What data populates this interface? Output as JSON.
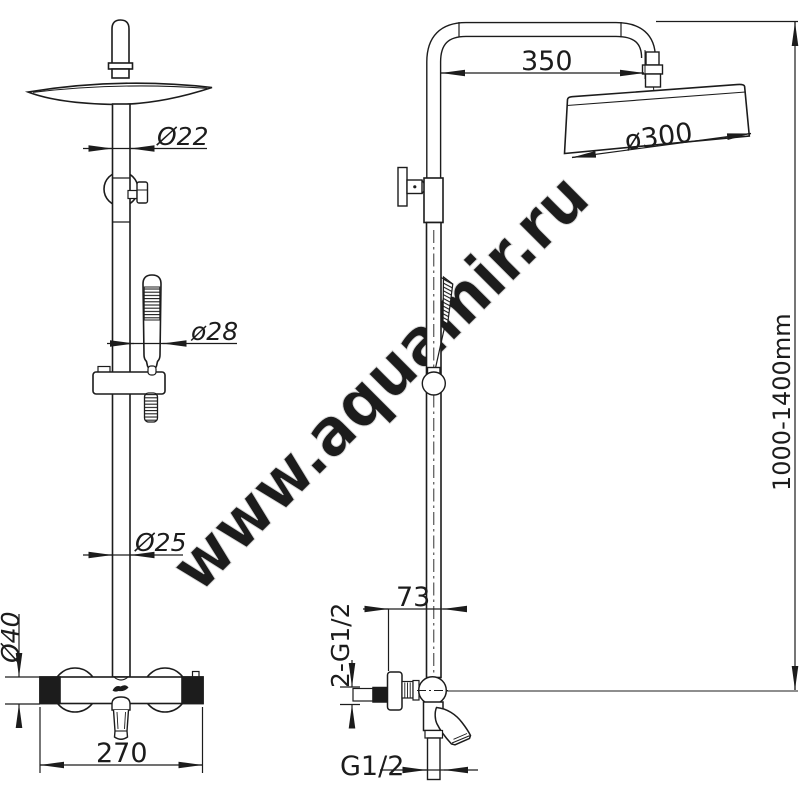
{
  "meta": {
    "background": "#ffffff",
    "line_color": "#1c1c1c",
    "drawing_type": "shower column technical drawing, front and side views"
  },
  "watermark": {
    "text": "www.aquamir.ru",
    "color": "#eaeaea"
  },
  "dimensions": {
    "upper_pipe_diameter": "Ø22",
    "handshower_diameter": "ø28",
    "riser_pipe_diameter": "Ø25",
    "mixer_body_diameter": "Ø40",
    "mixer_body_width": "270",
    "shower_arm_reach": "350",
    "head_diameter": "ø300",
    "column_height_range": "1000-1400mm",
    "wall_offset": "73",
    "inlet_connections": "2-G1/2",
    "outlet_connection": "G1/2"
  }
}
